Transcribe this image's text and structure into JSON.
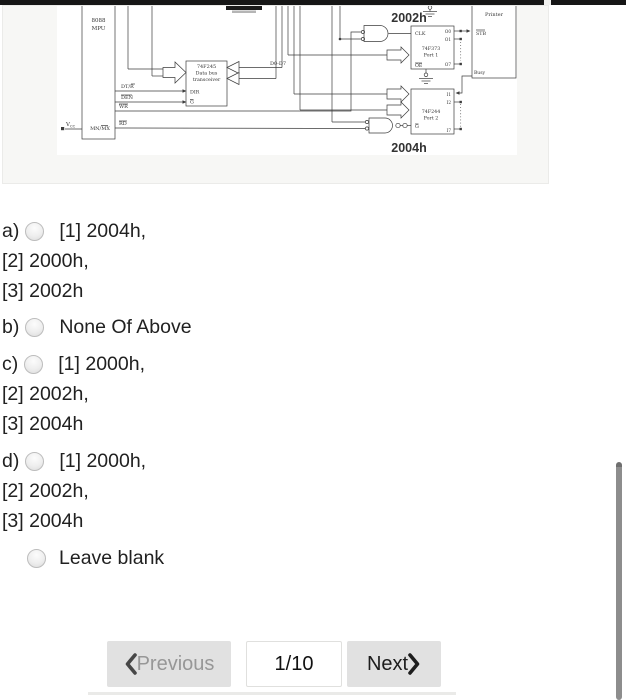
{
  "figure": {
    "colors": {
      "address_label": "#4646aa"
    },
    "labels": {
      "mpu1": "8088",
      "mpu2": "MPU",
      "mn_mx": "MN/MX",
      "vcc": "V",
      "vcc_sub": "CC",
      "dt_r": "DT/R",
      "den": "DEN",
      "wr": "WR",
      "rd": "RD",
      "xcvr1": "74F245",
      "xcvr2": "Data bus",
      "xcvr3": "transceiver",
      "dir": "DIR",
      "g_xcvr": "G",
      "d_bus": "D0-D7",
      "port1_addr": "2002h",
      "port2_addr": "2004h",
      "clk": "CLK",
      "port1_1": "74F373",
      "port1_2": "Port 1",
      "oe": "OE",
      "o0": "O0",
      "o1": "O1",
      "o7": "O7",
      "printer": "Printer",
      "stb": "STB",
      "busy": "Busy",
      "port2_1": "74F244",
      "port2_2": "Port 2",
      "g_port2": "G",
      "i1": "I1",
      "i2": "I2",
      "i7": "I7"
    }
  },
  "question": {
    "options": [
      {
        "key": "a)",
        "lines": [
          "[1] 2004h,",
          "[2] 2000h,",
          "[3] 2002h"
        ]
      },
      {
        "key": "b)",
        "lines": [
          "None Of Above"
        ]
      },
      {
        "key": "c)",
        "lines": [
          "[1] 2000h,",
          "[2] 2002h,",
          "[3] 2004h"
        ]
      },
      {
        "key": "d)",
        "lines": [
          "[1] 2000h,",
          "[2] 2002h,",
          "[3] 2004h"
        ]
      }
    ],
    "leave_blank": "Leave blank"
  },
  "pagination": {
    "previous": "Previous",
    "page_indicator": "1/10",
    "next": "Next"
  }
}
